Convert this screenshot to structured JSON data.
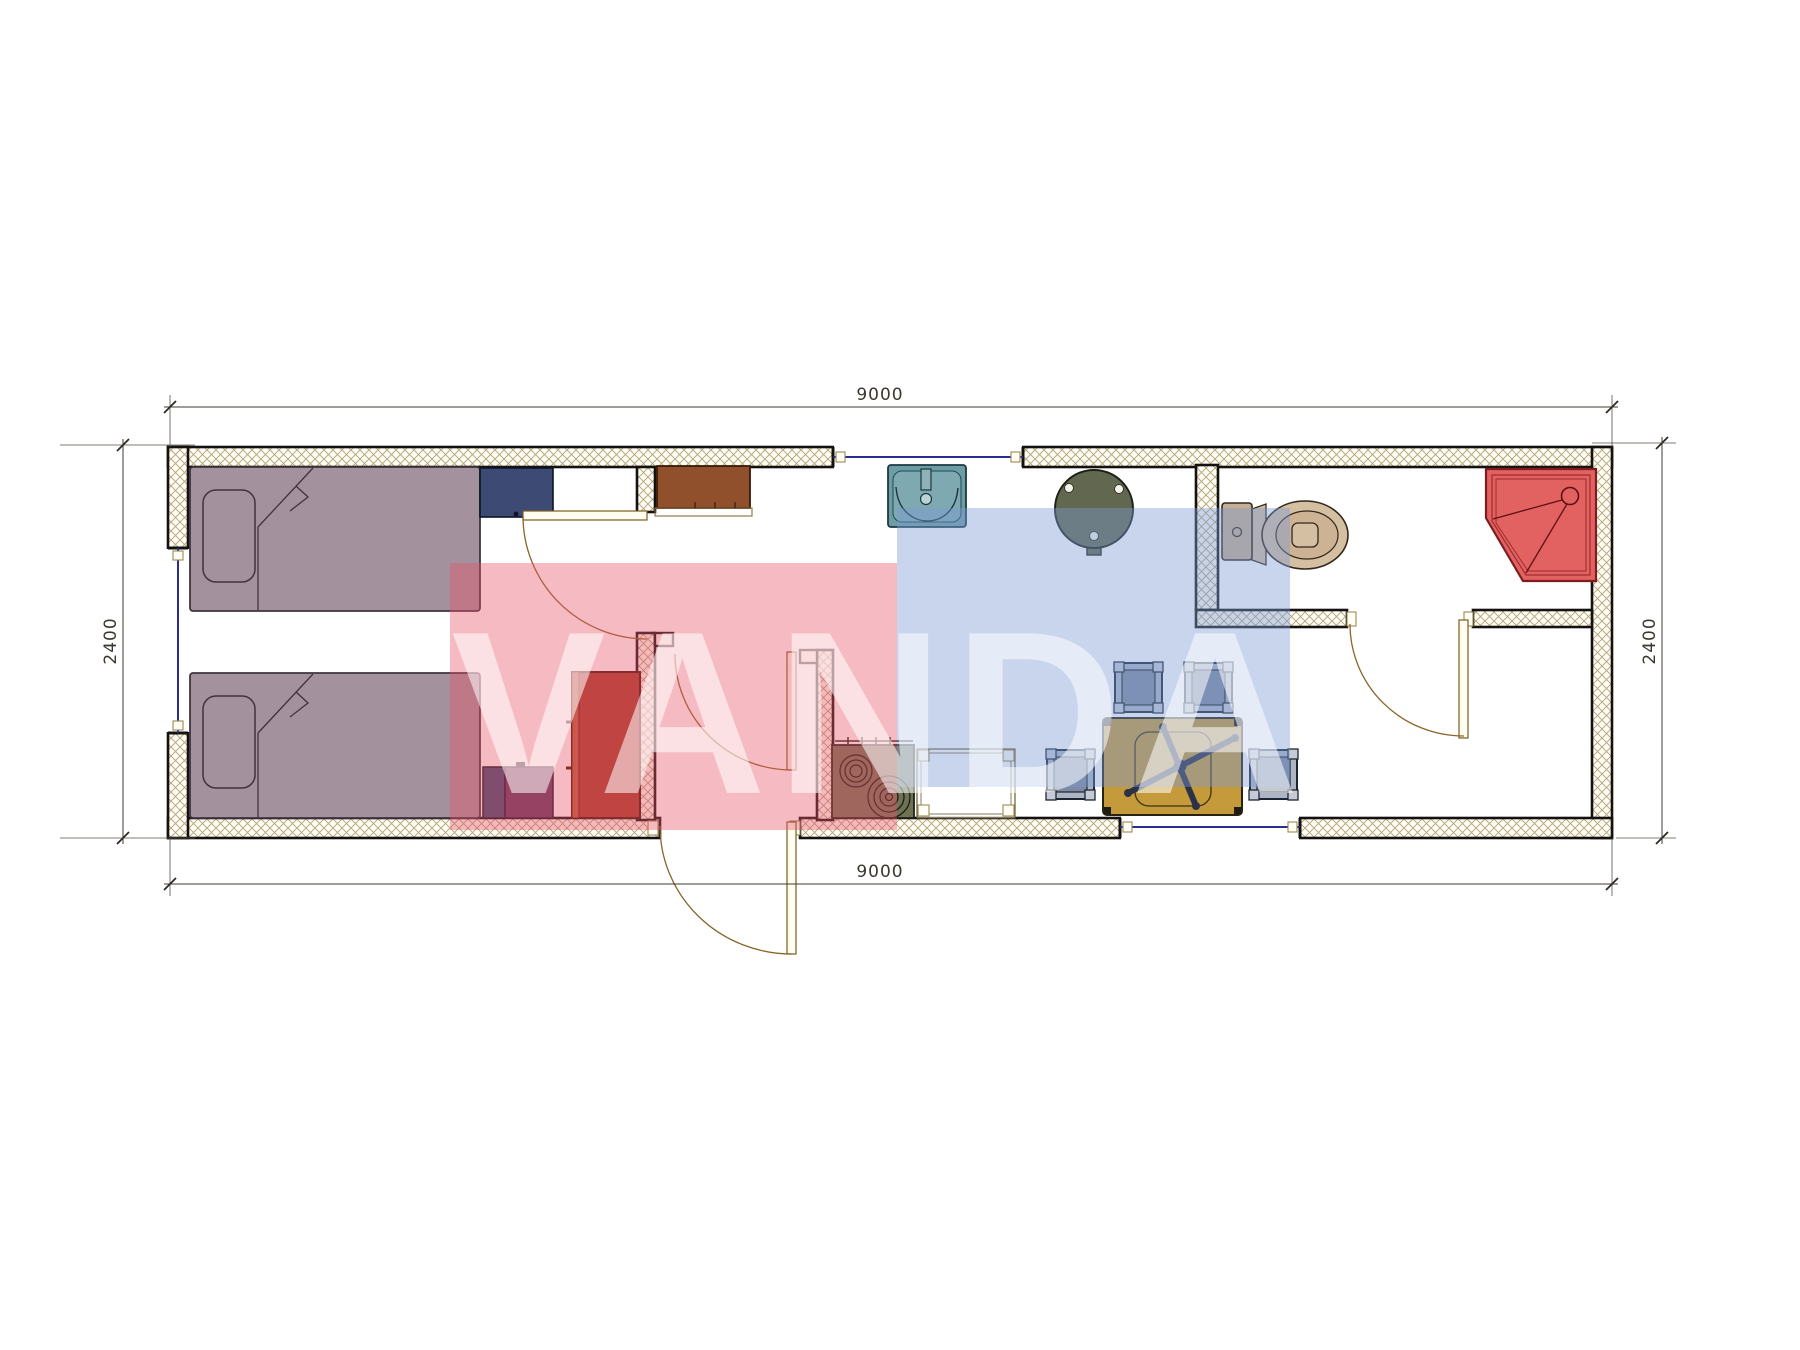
{
  "dims": {
    "top": "9000",
    "bottom": "9000",
    "left": "2400",
    "right": "2400"
  },
  "watermark": {
    "text": "VANDA",
    "pink_block_color": "#e9526a",
    "blue_block_color": "#7d9cd4",
    "letter_color": "#ffffff"
  },
  "colors": {
    "wall_hatch": "#b3a275",
    "wall_outline": "#141210",
    "window": "#2b2e8c",
    "door": "#8a6428",
    "bed": "#a3919d",
    "nightstand_blue": "#3d4a74",
    "nightstand_purple": "#5e3860",
    "cabinet_brown": "#91502c",
    "wardrobe_red": "#a53b27",
    "sink_teal": "#6e9ba4",
    "stove_olive": "#6f7355",
    "round_table": "#62684f",
    "stool": "#9fa8ba",
    "dining_table_yellow": "#c49a3a",
    "toilet_beige": "#d5bfa2",
    "shower_red": "#e26161"
  },
  "symbols": [
    "single-bed",
    "single-bed",
    "nightstand",
    "nightstand",
    "wardrobe",
    "kitchen-cabinet",
    "kitchen-sink",
    "stove",
    "kitchen-counter",
    "round-table",
    "dining-table",
    "stool",
    "stool",
    "stool",
    "stool",
    "toilet",
    "corner-shower",
    "door",
    "door",
    "door",
    "door",
    "window",
    "window",
    "window"
  ]
}
